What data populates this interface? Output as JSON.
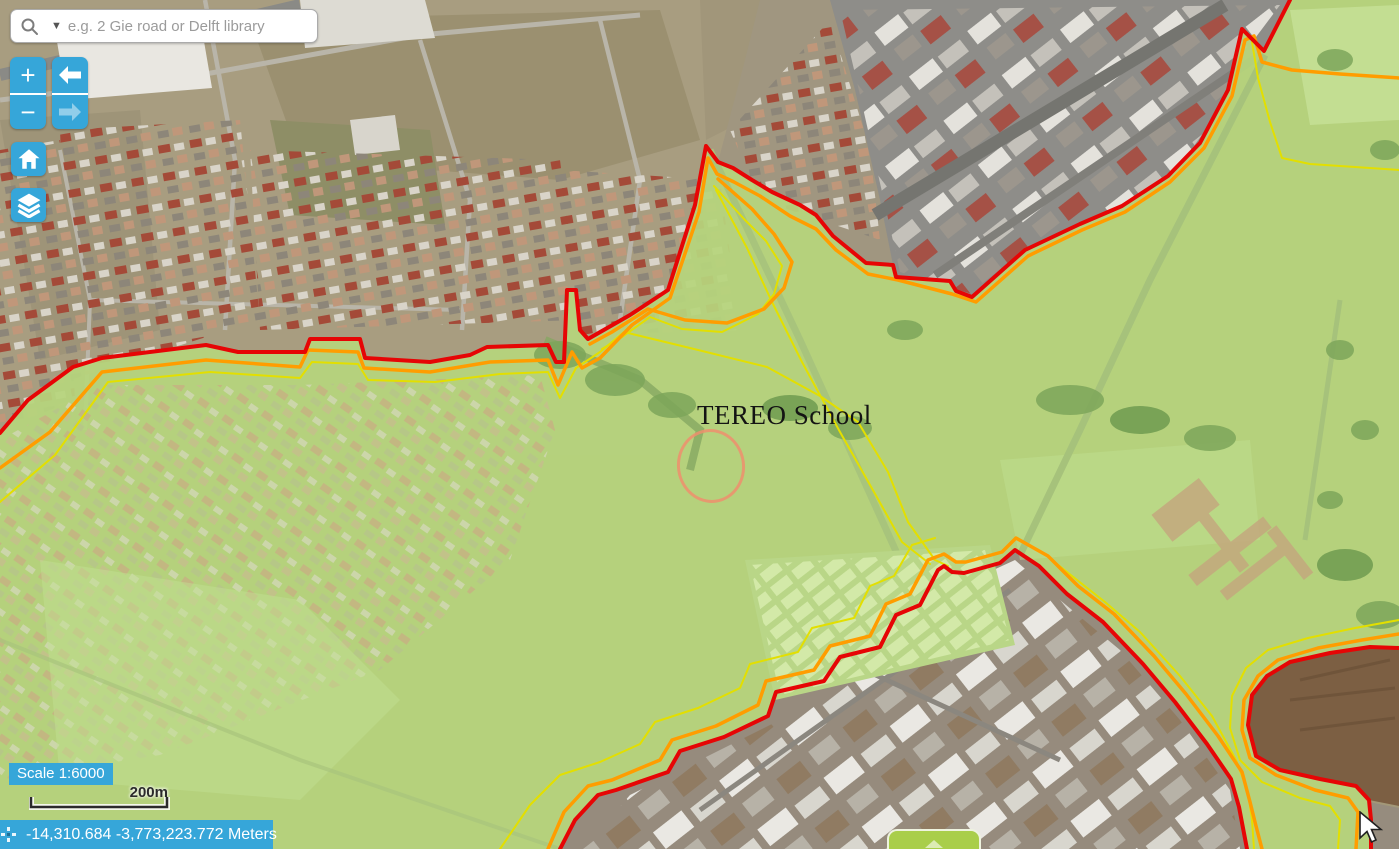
{
  "search": {
    "placeholder": "e.g. 2 Gie road or Delft library",
    "icons": [
      "search-icon",
      "dropdown-caret-icon"
    ]
  },
  "toolbar": {
    "zoom_in_label": "+",
    "zoom_out_label": "−",
    "icons": [
      "back-arrow-icon",
      "forward-arrow-icon",
      "home-icon",
      "layers-icon"
    ],
    "forward_disabled": true
  },
  "map": {
    "school_label": "TEREO School",
    "annotations": [
      "highlight-circle around school building",
      "mouse-cursor"
    ]
  },
  "statusbar": {
    "scale_label": "Scale 1:6000",
    "scalebar_distance": "200m",
    "coordinates": "-14,310.684 -3,773,223.772 Meters",
    "icons": [
      "crosshair-icon"
    ]
  },
  "expand_panel": {
    "icon": "up-arrow-icon"
  },
  "colors": {
    "accent": "#36a6d9",
    "boundary_red": "#e60505",
    "boundary_orange": "#ff9d00",
    "boundary_yellow": "#e3df00",
    "overlay_green": "#b6d57d",
    "highlight_circle": "#ef8f6d",
    "expand_button_green": "#a9ce4a"
  }
}
